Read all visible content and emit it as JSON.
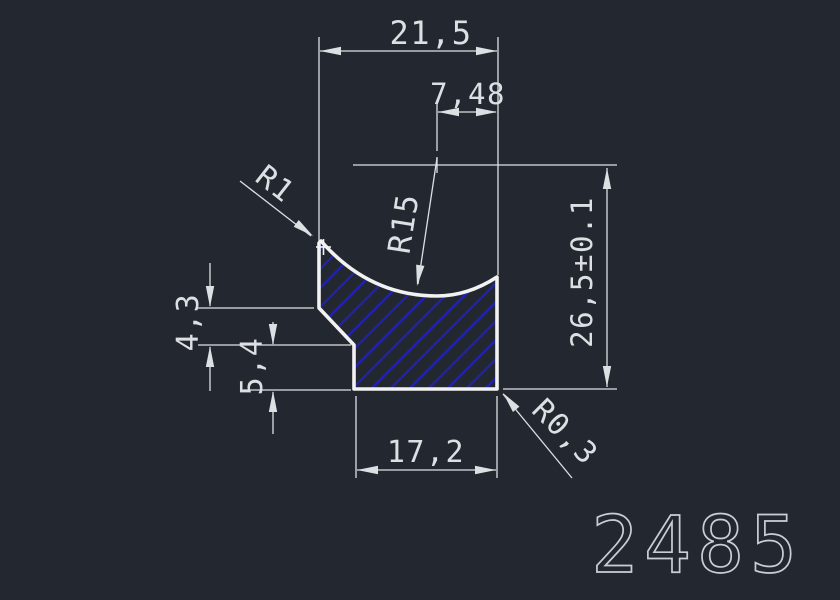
{
  "drawing": {
    "part_number": "2485",
    "dimensions": {
      "top_width": "21,5",
      "inner_width": "7,48",
      "total_height": "26,5±0.1",
      "step_height": "4,3",
      "base_height": "5,4",
      "bottom_width": "17,2"
    },
    "radii": {
      "top_corner": "R1",
      "concave_curve": "R15",
      "bottom_corner": "R0,3"
    },
    "colors": {
      "background": "#232830",
      "outline": "#f2f2f2",
      "dimension_line": "#dde0e3",
      "hatch": "#2121b5",
      "part_number": "#c9ced6"
    }
  }
}
